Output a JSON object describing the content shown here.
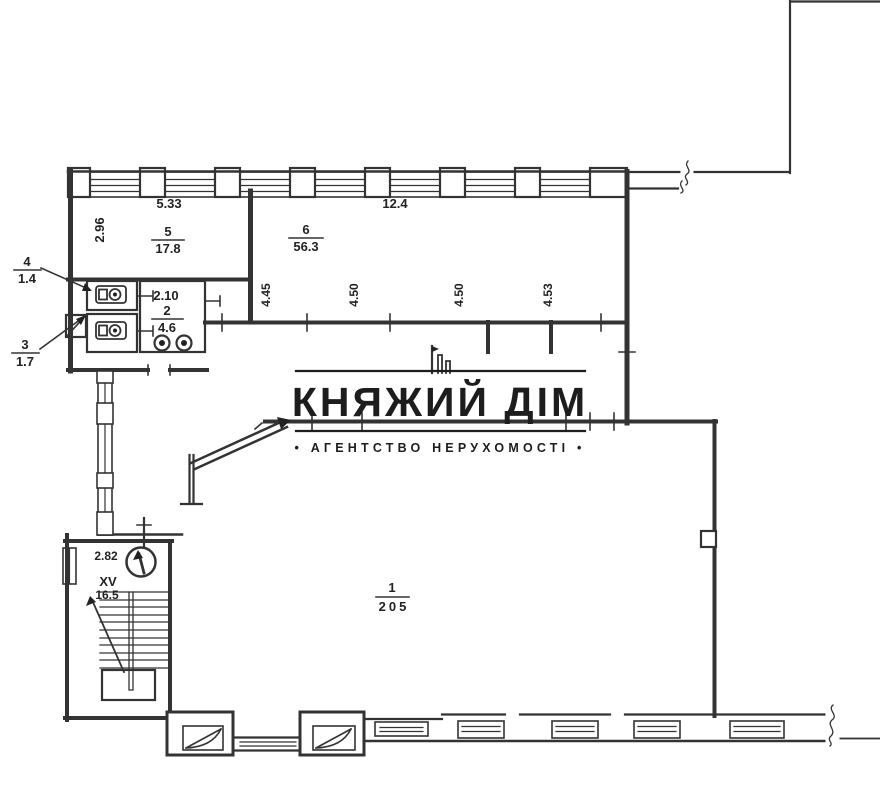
{
  "plan": {
    "rooms": {
      "room1": {
        "number": "1",
        "area": "205"
      },
      "room2": {
        "number": "2",
        "area": "4.6",
        "width": "2.10"
      },
      "room3": {
        "number": "3",
        "area": "1.7"
      },
      "room4": {
        "number": "4",
        "area": "1.4"
      },
      "room5": {
        "number": "5",
        "area": "17.8",
        "width": "5.33",
        "depth": "2.96"
      },
      "room6": {
        "number": "6",
        "area": "56.3",
        "width": "12.4",
        "segments": [
          "4.45",
          "4.50",
          "4.50",
          "4.53"
        ]
      },
      "stairs": {
        "number": "XV",
        "area": "16.5",
        "width": "2.82"
      }
    }
  },
  "watermark": {
    "title": "КНЯЖИЙ ДІМ",
    "tagline": "• АГЕНТСТВО НЕРУХОМОСТІ •"
  }
}
